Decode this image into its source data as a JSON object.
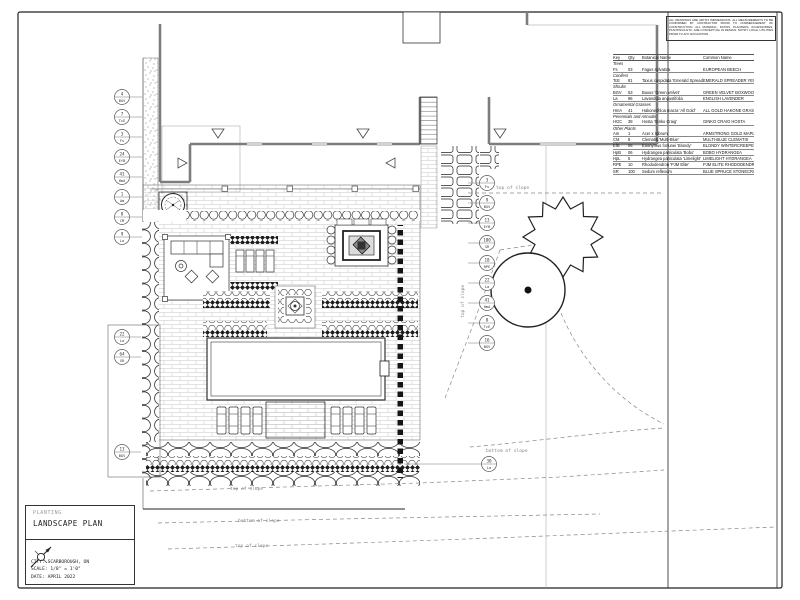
{
  "colors": {
    "paper": "#ffffff",
    "ink": "#222222",
    "wall_gray": "#7d7d7d",
    "annotation_gray": "#888888"
  },
  "notes_box": {
    "text": "ALL DRAWINGS ARE ARTIST IMPRESSIONS. ALL MEASUREMENTS TO BE CONFIRMED BY CONTRACTOR PRIOR TO COMMENCEMENT OF CONSTRUCTION. ALL MATERIAL, PATIOS, PLANTERS, ACCESSORIES, PLANTINGS ETC. ARE CONCEPTUAL IN DESIGN. NOTIFY LOCAL UTILITIES PRIOR TO ANY EXCAVATION."
  },
  "plant_schedule": {
    "headers": [
      "Key",
      "Qty.",
      "Botanical Name",
      "Common Name"
    ],
    "groups": [
      {
        "name": "Trees",
        "rows": [
          [
            "Fs",
            "03",
            "Fagus sylvatica",
            "EUROPEAN BEECH"
          ]
        ]
      },
      {
        "name": "Conifers",
        "rows": [
          [
            "TcE",
            "81",
            "Taxus cuspidata 'Emerald Spreader'",
            "EMERALD SPREADER YEW"
          ]
        ]
      },
      {
        "name": "Shrubs",
        "rows": [
          [
            "BGV",
            "53",
            "Buxus 'Green Velvet'",
            "GREEN VELVET BOXWOOD"
          ],
          [
            "La",
            "96",
            "Lavandula angustifolia",
            "ENGLISH LAVENDER"
          ]
        ]
      },
      {
        "name": "Ornamental Grasses",
        "rows": [
          [
            "HmA",
            "41",
            "Hakonechloa macra 'All Gold'",
            "ALL GOLD HAKONE GRASS"
          ]
        ]
      },
      {
        "name": "Perennials and Annuals",
        "rows": [
          [
            "HGC",
            "38",
            "Hosta 'Ginko Craig'",
            "GINKO CRAIG HOSTA"
          ]
        ]
      },
      {
        "name": "Other Plants",
        "rows": [
          [
            "Am",
            "1",
            "Acer x rubrum",
            "ARMSTRONG GOLD MAPLE"
          ],
          [
            "CM",
            "8",
            "Clematis 'Multi-Blue'",
            "MULTI-BLUE CLEMATIS"
          ],
          [
            "EfB",
            "06",
            "Euonymus fortunei 'Blondy'",
            "BLONDY WINTERCREEPER"
          ],
          [
            "HpB",
            "06",
            "Hydrangea paniculata 'Bobo'",
            "BOBO HYDRANGEA"
          ],
          [
            "HpL",
            "5",
            "Hydrangea paniculata 'Limelight'",
            "LIMELIGHT HYDRANGEA"
          ],
          [
            "RPE",
            "10",
            "Rhododendron 'PJM Elite'",
            "PJM ELITE RHODODENDRON"
          ],
          [
            "SR",
            "100",
            "Sedum reflexum",
            "BLUE SPRUCE STONECROP"
          ]
        ]
      }
    ]
  },
  "title_block": {
    "subtitle": "PLANTING",
    "title": "LANDSCAPE PLAN",
    "city": "CITY: SCARBOROUGH, ON",
    "scale": "SCALE: 1/8\" = 1'0\"",
    "date": "DATE: APRIL 2022"
  },
  "plan_labels": {
    "top_of_slope": "top of slope",
    "bottom_of_slope": "bottom of slope"
  },
  "callouts": {
    "left": [
      {
        "qty": "4",
        "key": "BGV"
      },
      {
        "qty": "7",
        "key": "TcE"
      },
      {
        "qty": "3",
        "key": "Fs"
      },
      {
        "qty": "24",
        "key": "EfB"
      },
      {
        "qty": "41",
        "key": "HmA"
      },
      {
        "qty": "1",
        "key": "Am"
      },
      {
        "qty": "8",
        "key": "CM"
      },
      {
        "qty": "9",
        "key": "La"
      }
    ],
    "left_mid": [
      {
        "qty": "22",
        "key": "La"
      },
      {
        "qty": "64",
        "key": "SR"
      }
    ],
    "left_bottom": [
      {
        "qty": "13",
        "key": "BGV"
      }
    ],
    "right": [
      {
        "qty": "3",
        "key": "Fs"
      },
      {
        "qty": "9",
        "key": "BGV"
      },
      {
        "qty": "13",
        "key": "EfB"
      },
      {
        "qty": "100",
        "key": "SR"
      },
      {
        "qty": "10",
        "key": "RPE"
      },
      {
        "qty": "22",
        "key": "La"
      },
      {
        "qty": "41",
        "key": "HmA"
      },
      {
        "qty": "8",
        "key": "TcE"
      },
      {
        "qty": "16",
        "key": "BGV"
      }
    ],
    "right_low": [
      {
        "qty": "30",
        "key": "La"
      }
    ]
  }
}
